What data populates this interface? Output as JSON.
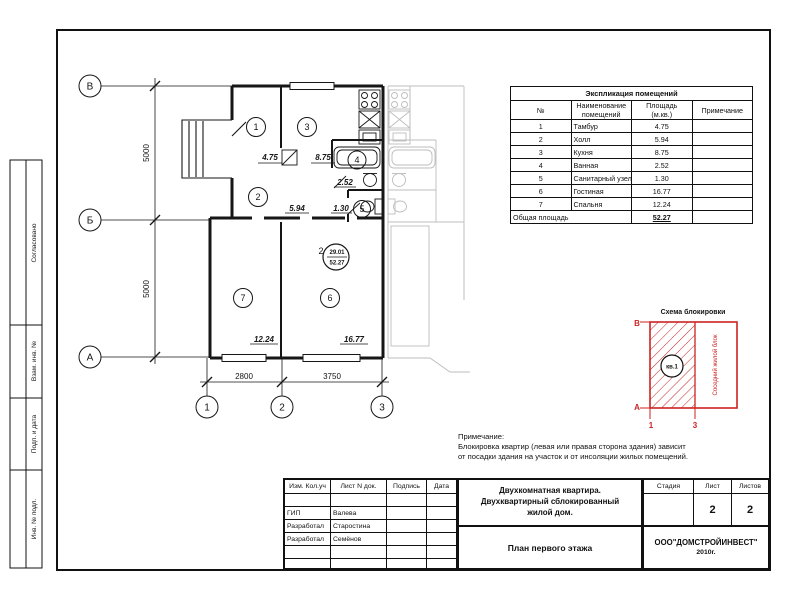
{
  "left_strip": {
    "labels": [
      "Согласовано",
      "Взам. инв. №",
      "Подп. и дата",
      "Инв. № подл."
    ]
  },
  "plan": {
    "axis_rows": [
      "В",
      "Б",
      "А"
    ],
    "axis_cols": [
      "1",
      "2",
      "3"
    ],
    "dim_vertical": [
      "5000",
      "5000"
    ],
    "dim_horizontal": [
      "2800",
      "3750"
    ],
    "rooms": [
      {
        "num": "1",
        "area": "4.75"
      },
      {
        "num": "2",
        "area": "5.94"
      },
      {
        "num": "3",
        "area": "8.75"
      },
      {
        "num": "4",
        "area": "2.52"
      },
      {
        "num": "5",
        "area": "1.30"
      },
      {
        "num": "6",
        "area": "16.77"
      },
      {
        "num": "7",
        "area": "12.24"
      }
    ],
    "marker": {
      "rooms_count": "2",
      "living_area": "29.01",
      "total_area": "52.27"
    }
  },
  "table": {
    "title": "Экспликация помещений",
    "headers": {
      "no": "№",
      "name1": "Наименование",
      "name2": "помещений",
      "area1": "Площадь",
      "area2": "(м.кв.)",
      "note": "Примечание"
    },
    "rows": [
      {
        "n": "1",
        "name": "Тамбур",
        "area": "4.75"
      },
      {
        "n": "2",
        "name": "Холл",
        "area": "5.94"
      },
      {
        "n": "3",
        "name": "Кухня",
        "area": "8.75"
      },
      {
        "n": "4",
        "name": "Ванная",
        "area": "2.52"
      },
      {
        "n": "5",
        "name": "Санитарный узел",
        "area": "1.30"
      },
      {
        "n": "6",
        "name": "Гостиная",
        "area": "16.77"
      },
      {
        "n": "7",
        "name": "Спальня",
        "area": "12.24"
      }
    ],
    "total_label": "Общая площадь",
    "total_value": "52.27"
  },
  "scheme": {
    "title": "Схема блокировки",
    "axis_top": "В",
    "axis_bottom": "А",
    "axis_left_num": "1",
    "axis_right_num": "3",
    "flat_label": "кв.1",
    "neighbor_label": "Соседний жилой блок",
    "accent_color": "#cc2222"
  },
  "notes": {
    "label": "Примечание:",
    "line1": "Блокировка квартир (левая или правая сторона здания) зависит",
    "line2": "от посадки здания на участок и от инсоляции жилых помещений."
  },
  "titleblock": {
    "cols": [
      "Изм. Кол.уч",
      "Лист N док.",
      "Подпись",
      "Дата"
    ],
    "people": [
      {
        "role": "ГИП",
        "name": "Валева"
      },
      {
        "role": "Разработал",
        "name": "Старостина"
      },
      {
        "role": "Разработал",
        "name": "Семёнов"
      }
    ],
    "title_line1": "Двухкомнатная квартира.",
    "title_line2": "Двухквартирный сблокированный",
    "title_line3": "жилой дом.",
    "drawing_name": "План первого этажа",
    "stage_label": "Стадия",
    "sheet_label": "Лист",
    "sheets_label": "Листов",
    "sheet": "2",
    "sheets": "2",
    "company": "ООО\"ДОМСТРОЙИНВЕСТ\"",
    "year": "2010г."
  }
}
